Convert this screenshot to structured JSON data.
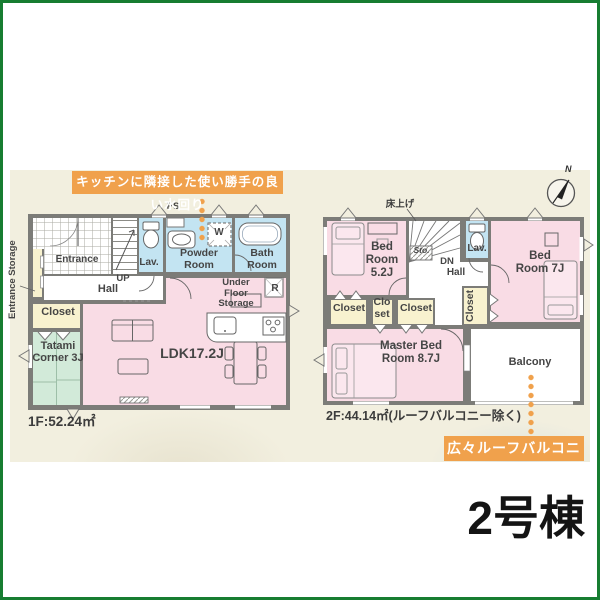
{
  "annotations": {
    "kitchen": "キッチンに隣接した使い勝手の良い水回り",
    "roof_balcony": "広々ルーフバルコニー"
  },
  "building_label": "2号棟",
  "compass": {
    "north": "N"
  },
  "floor1": {
    "area": "1F:52.24㎡",
    "labels": {
      "entrance_storage": "Entrance Storage",
      "ps": "PS",
      "entrance": "Entrance",
      "up": "UP",
      "hall": "Hall",
      "lav": "Lav.",
      "powder_room": "Powder Room",
      "washer": "W",
      "bath_room": "Bath Room",
      "under_floor_storage": "Under Floor Storage",
      "refrigerator": "R",
      "closet": "Closet",
      "tatami_corner": "Tatami Corner 3J",
      "ldk": "LDK17.2J"
    }
  },
  "floor2": {
    "area": "2F:44.14㎡(ルーフバルコニー除く)",
    "labels": {
      "raised_floor": "床上げ",
      "bedroom_1": "Bed Room 5.2J",
      "storage": "Sto.",
      "down": "DN",
      "hall": "Hall",
      "lav": "Lav.",
      "bedroom_2": "Bed Room 7J",
      "closet_1": "Closet",
      "closet_2": "Clo set",
      "closet_3": "Closet",
      "closet_4": "Closet",
      "master_bedroom": "Master Bed Room 8.7J",
      "balcony": "Balcony"
    }
  },
  "colors": {
    "accent_orange": "#f0a14c",
    "wall_gray": "#7c7c78",
    "room_pink": "#f9dce5",
    "room_blue": "#c3e4f2",
    "room_cream": "#f8f2cf",
    "tatami_green": "#d2ead9",
    "frame_green": "#177d31",
    "canvas_cream": "#f2efdf"
  }
}
